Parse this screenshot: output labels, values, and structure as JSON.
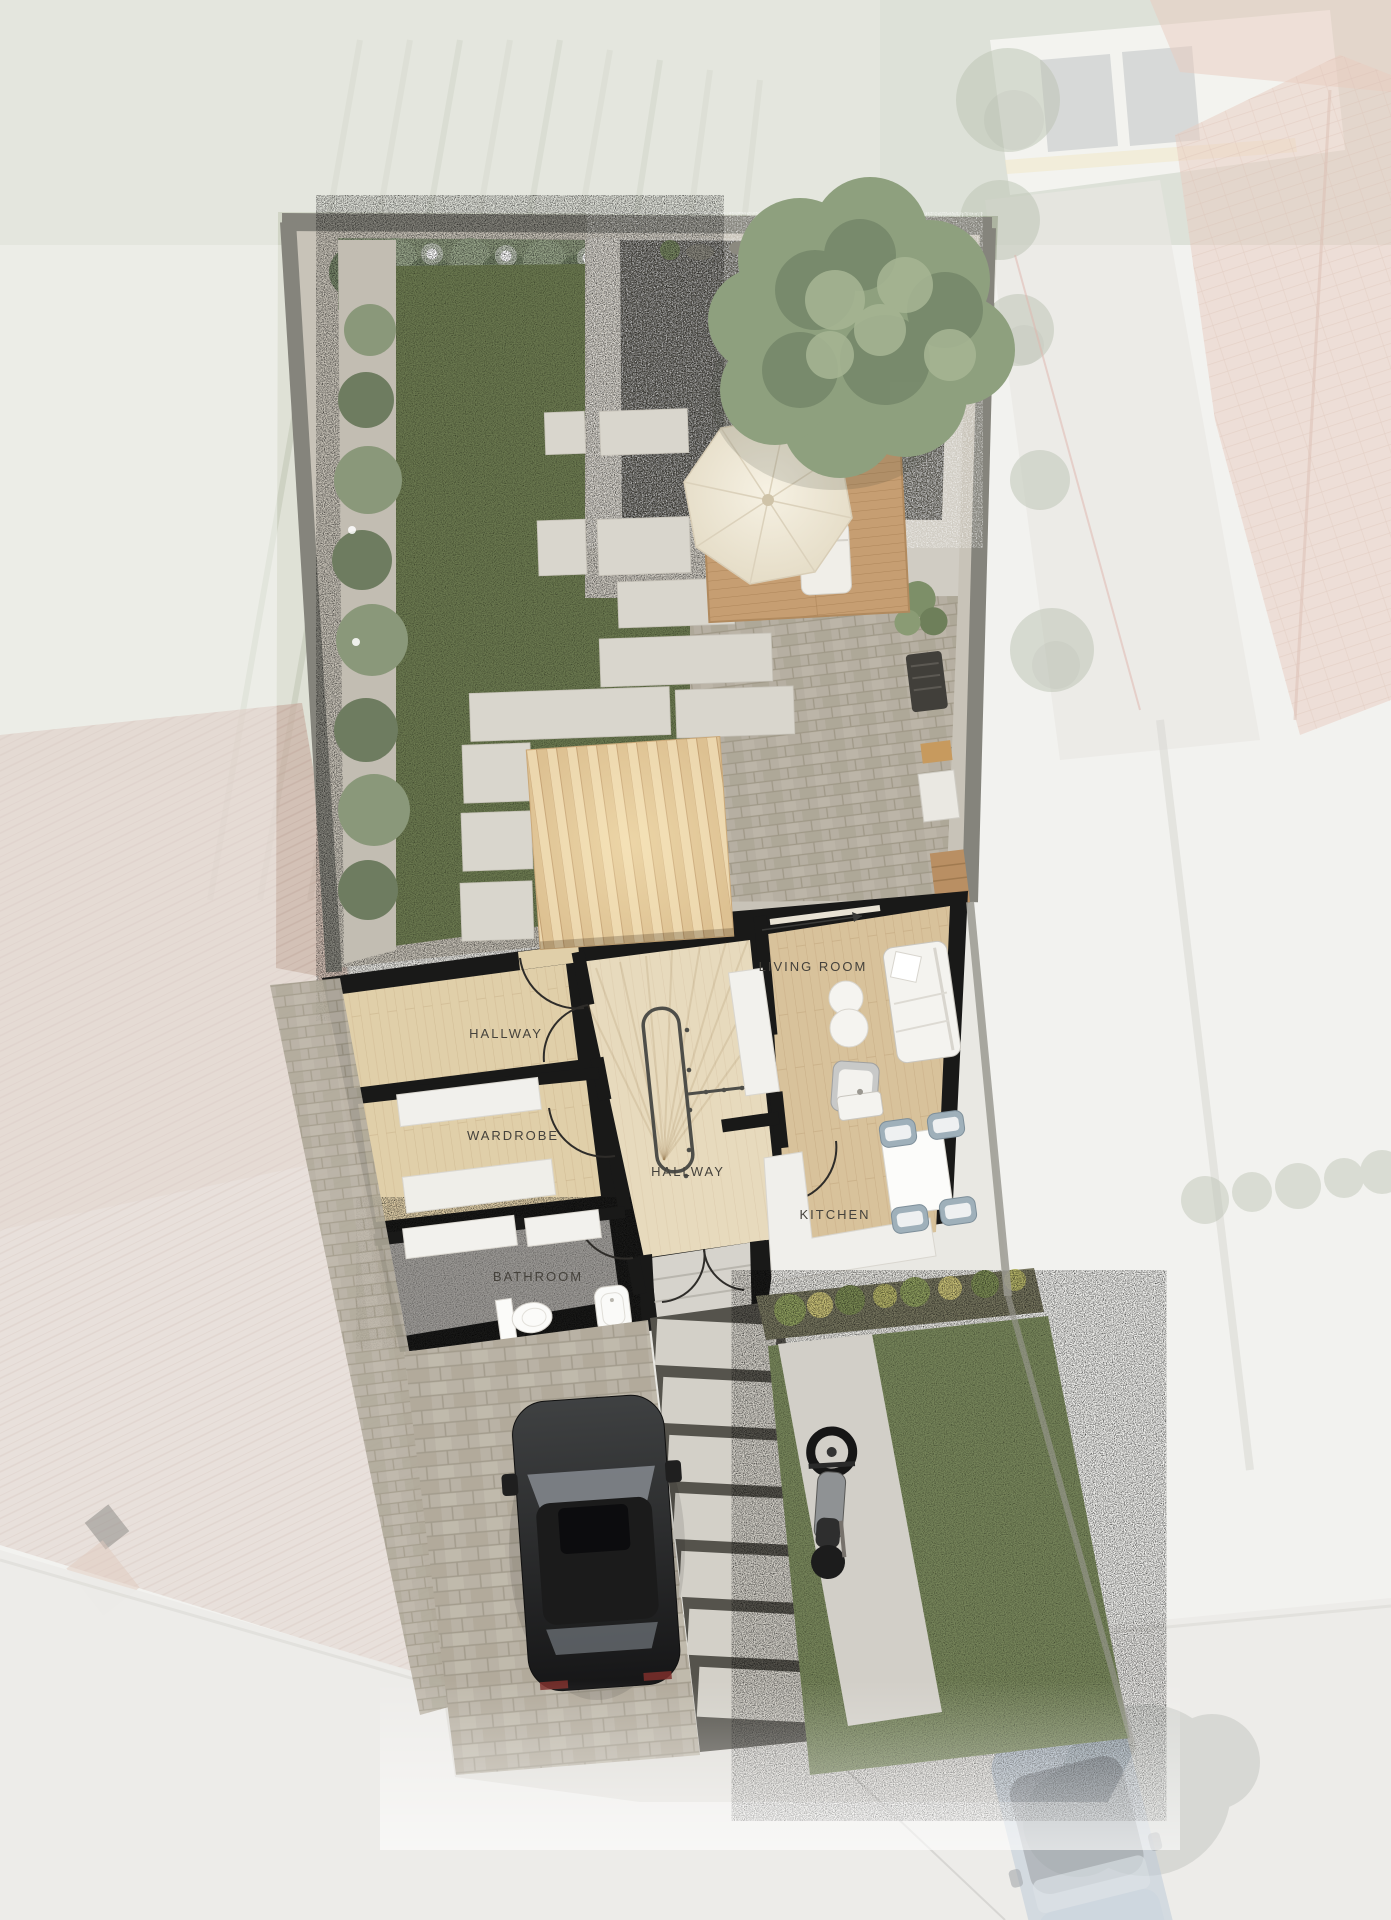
{
  "floor_plan": {
    "rooms": [
      {
        "id": "hallway-upper",
        "label": "HALLWAY"
      },
      {
        "id": "wardrobe",
        "label": "WARDROBE"
      },
      {
        "id": "bathroom",
        "label": "BATHROOM"
      },
      {
        "id": "hallway-central",
        "label": "HALLWAY"
      },
      {
        "id": "living-room",
        "label": "LIVING ROOM"
      },
      {
        "id": "kitchen",
        "label": "KITCHEN"
      }
    ]
  },
  "garden": {
    "features": [
      "tree-canopy",
      "parasol-umbrella",
      "pergola-canopy",
      "hedge-with-string-lights",
      "lawn",
      "stepping-stones",
      "dark-gravel-patio",
      "wood-deck",
      "sun-lounger",
      "brick-patio",
      "grill",
      "garden-bench",
      "shrub-border"
    ]
  },
  "vehicles": [
    "black-car-on-driveway",
    "motorcycle-on-parking-strip",
    "street-car-bottom-right"
  ],
  "furniture": {
    "living_room": [
      "sofa",
      "armchair",
      "round-side-tables",
      "sideboard"
    ],
    "kitchen": [
      "l-shaped-counter",
      "sink",
      "dining-table",
      "four-chairs"
    ],
    "bathroom": [
      "toilet",
      "washbasin",
      "shelving"
    ],
    "wardrobe": [
      "bench-counters"
    ]
  },
  "colors": {
    "wall_black": "#191918",
    "wood_floor": "#d8c29b",
    "wood_floor_light": "#e0cfa9",
    "stair_hall_floor": "#e7dabd",
    "bathroom_floor": "#9b9995",
    "lawn_green": "#6b7850",
    "hedge_green": "#8d9a7e",
    "gravel_dark": "#55524b",
    "paver_light": "#d7d4cb",
    "brick": "#b6afa2",
    "deck_wood": "#c69e72",
    "pergola_wood": "#ecd7ae",
    "umbrella_cream": "#ebe3d1",
    "label_text": "#45423c",
    "car_black": "#262626",
    "street_car_blue": "#8ba3bc"
  }
}
